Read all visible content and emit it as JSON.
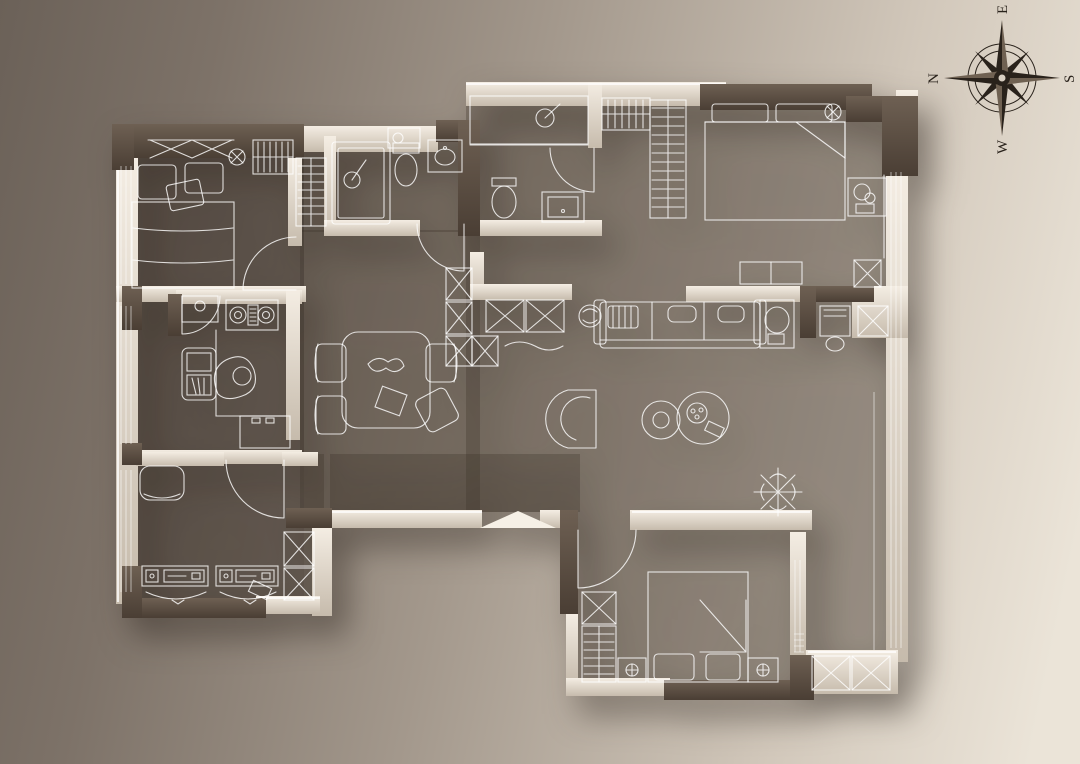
{
  "compass": {
    "top": "E",
    "left": "N",
    "right": "S",
    "bottom": "W"
  },
  "palette": {
    "bg_start": "#6b6158",
    "bg_mid": "#a3988c",
    "bg_end": "#ebe4d8",
    "wall_dark_hi": "#6e6053",
    "wall_dark_lo": "#4a3e34",
    "wall_light_hi": "#f4ede3",
    "wall_light_lo": "#c6bbac",
    "floor_shade": "rgba(59,49,41,0.30)",
    "floor_shade_left": "rgba(59,49,41,0.14)",
    "line": "rgba(255,255,255,0.82)",
    "compass_ink": "#29221b",
    "shadow": "rgba(35,28,22,0.5)"
  }
}
